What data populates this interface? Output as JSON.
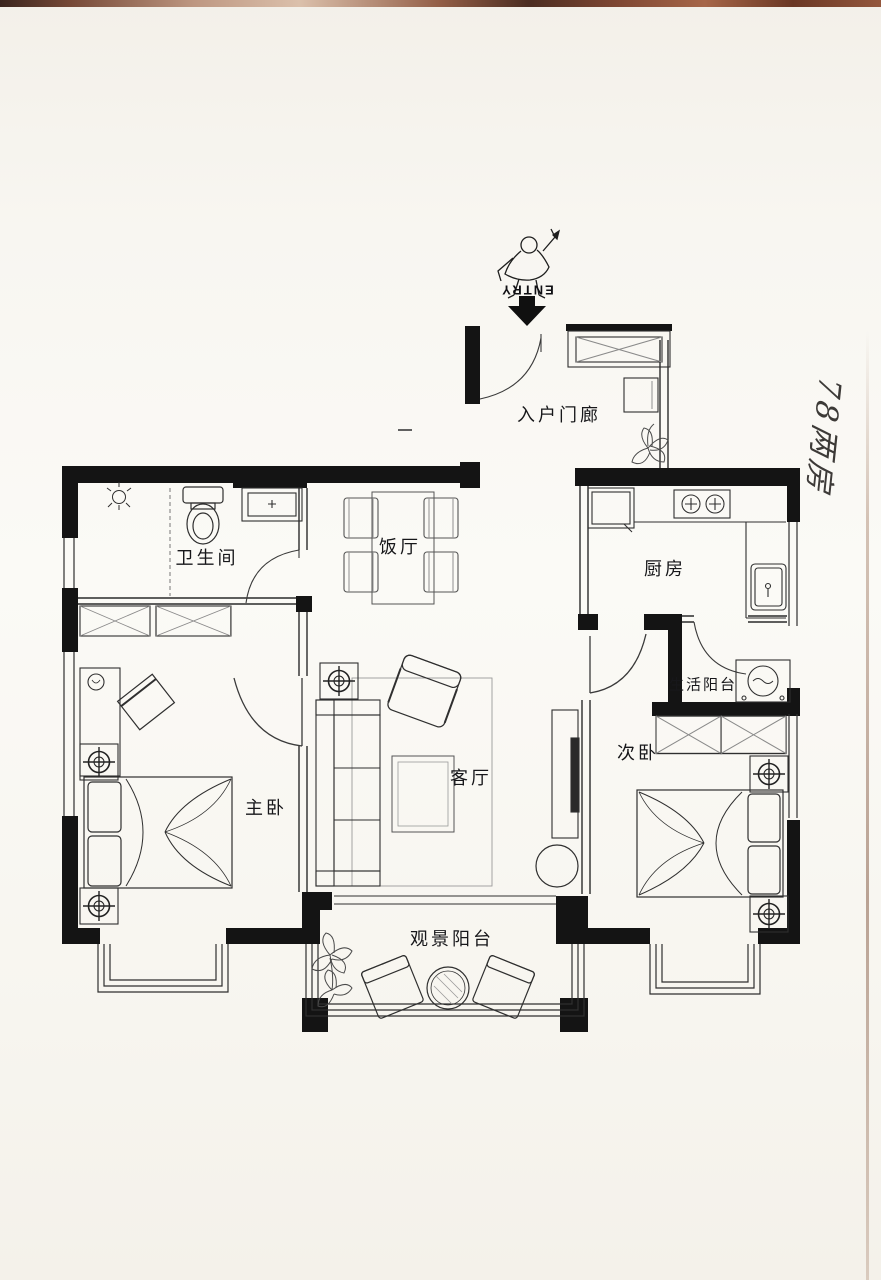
{
  "annotations": {
    "entry": "ENTRY",
    "handwritten": "78两房"
  },
  "rooms": {
    "entry_porch": "入户门廊",
    "dining_room": "饭厅",
    "bathroom": "卫生间",
    "kitchen": "厨房",
    "service_balcony": "生活阳台",
    "master_bedroom": "主卧",
    "living_room": "客厅",
    "second_bedroom": "次卧",
    "view_balcony": "观景阳台"
  },
  "colors": {
    "wall": "#141414",
    "paper": "#f7f5ef",
    "scan_edge": "#5e2713",
    "ink": "#2f2f2f"
  }
}
